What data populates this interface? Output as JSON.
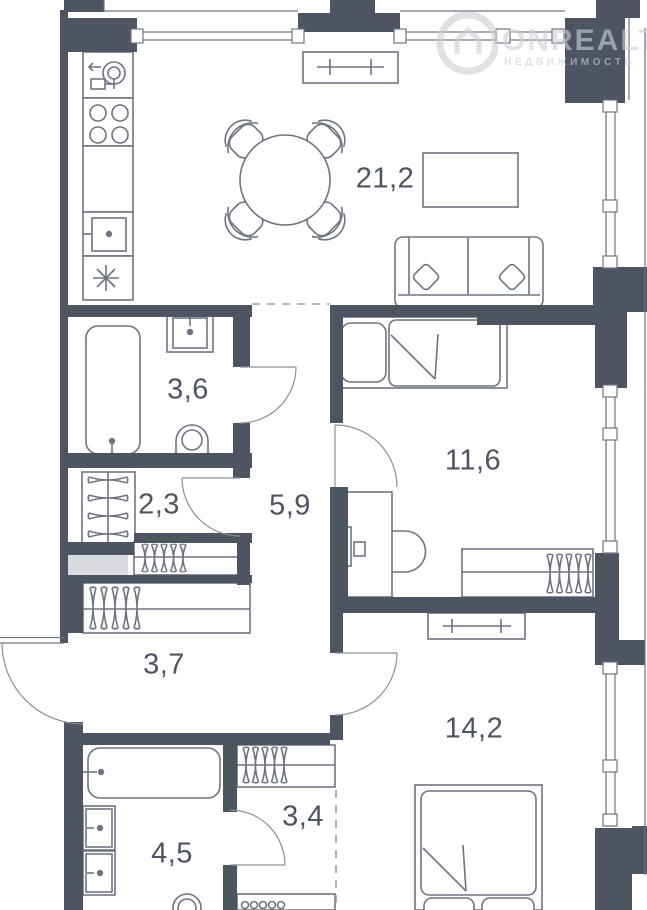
{
  "watermark": {
    "brand": "ONREALT",
    "subtitle": "НЕДВИЖИМОСТЬ"
  },
  "rooms": [
    {
      "id": "kitchen-living-room",
      "area": "21,2"
    },
    {
      "id": "bathroom",
      "area": "3,6"
    },
    {
      "id": "bedroom",
      "area": "11,6"
    },
    {
      "id": "wardrobe",
      "area": "2,3"
    },
    {
      "id": "hallway",
      "area": "5,9"
    },
    {
      "id": "corridor",
      "area": "3,7"
    },
    {
      "id": "bedroom-2",
      "area": "14,2"
    },
    {
      "id": "closet",
      "area": "3,4"
    },
    {
      "id": "bathroom-2",
      "area": "4,5"
    }
  ],
  "colors": {
    "wall": "#4d5562",
    "furniture_line": "#6e7480",
    "label_text": "#4d5562",
    "shaft_fill": "#d9dbdf",
    "watermark": "#cbcfd5"
  }
}
